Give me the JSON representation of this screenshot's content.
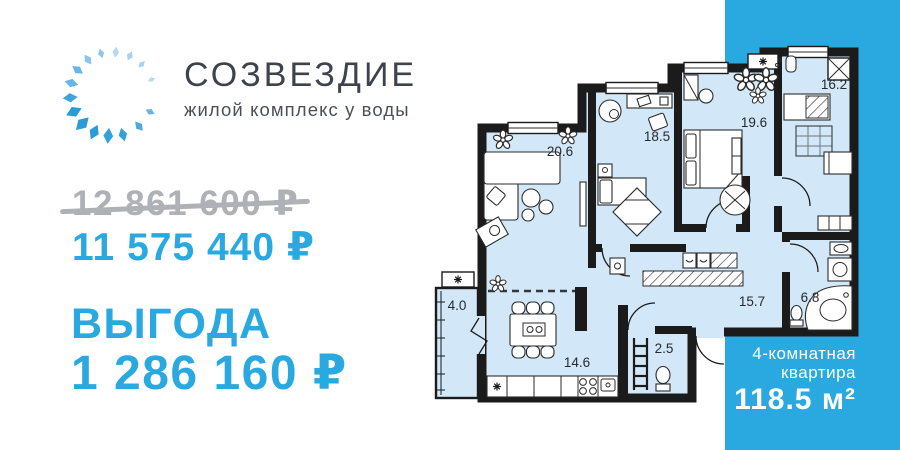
{
  "brand": {
    "name": "СОЗВЕЗДИЕ",
    "tagline": "жилой комплекс у воды"
  },
  "pricing": {
    "old_price": "12 861 600 ₽",
    "new_price": "11 575 440 ₽",
    "benefit_label": "ВЫГОДА",
    "benefit_value": "1 286 160 ₽"
  },
  "floor_plan": {
    "room_areas": {
      "living_room": "20.6",
      "bedroom_1": "18.5",
      "bedroom_2": "19.6",
      "bedroom_3": "16.2",
      "hallway": "15.7",
      "bathroom": "6.8",
      "balcony": "4.0",
      "kitchen_dining": "14.6",
      "wc": "2.5"
    },
    "apartment_type_line1": "4-комнатная",
    "apartment_type_line2": "квартира",
    "apartment_area": "118.5 м²"
  },
  "colors": {
    "accent_blue": "#29a9e0",
    "plan_fill": "#d2e8f8",
    "wall_black": "#1b1b1b",
    "muted_gray": "#aeb1b6",
    "brand_text": "#3e434b"
  }
}
